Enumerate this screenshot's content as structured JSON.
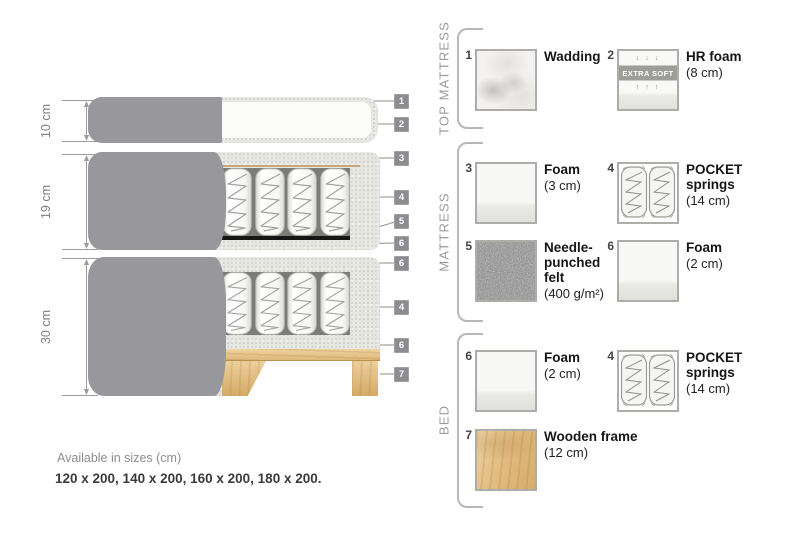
{
  "diagram": {
    "dimensions": [
      {
        "label": "10 cm"
      },
      {
        "label": "19 cm"
      },
      {
        "label": "30 cm"
      }
    ],
    "tags": [
      "1",
      "2",
      "3",
      "4",
      "5",
      "6",
      "6",
      "4",
      "6",
      "7"
    ]
  },
  "legend": {
    "sections": [
      {
        "label": "TOP MATTRESS"
      },
      {
        "label": "MATTRESS"
      },
      {
        "label": "BED"
      }
    ],
    "items": [
      {
        "num": "1",
        "name": "Wadding",
        "size": ""
      },
      {
        "num": "2",
        "name": "HR foam",
        "size": "(8 cm)",
        "badge": "EXTRA SOFT",
        "arrows_down": "↓ ↓ ↓",
        "arrows_up": "↑ ↑ ↑"
      },
      {
        "num": "3",
        "name": "Foam",
        "size": "(3 cm)"
      },
      {
        "num": "4",
        "name": "POCKET\nsprings",
        "size": "(14 cm)"
      },
      {
        "num": "5",
        "name": "Needle-\npunched\nfelt",
        "size": "(400 g/m²)"
      },
      {
        "num": "6",
        "name": "Foam",
        "size": "(2 cm)"
      },
      {
        "num": "6",
        "name": "Foam",
        "size": "(2 cm)"
      },
      {
        "num": "4",
        "name": "POCKET\nsprings",
        "size": "(14 cm)"
      },
      {
        "num": "7",
        "name": "Wooden frame",
        "size": "(12 cm)"
      }
    ]
  },
  "footer": {
    "title": "Available in sizes (cm)",
    "sizes": "120 x 200, 140 x 200, 160 x 200, 180 x 200."
  },
  "colors": {
    "cover_grey": "#97979c",
    "foam_speckle": "#e6e6e3",
    "wood": "#e0ba7d",
    "felt_grey": "#8c8c8c",
    "tag_grey": "#8c8c91",
    "leader_line": "#a3a3a3",
    "text_dark": "#161616",
    "text_muted": "#8d8d8d"
  }
}
